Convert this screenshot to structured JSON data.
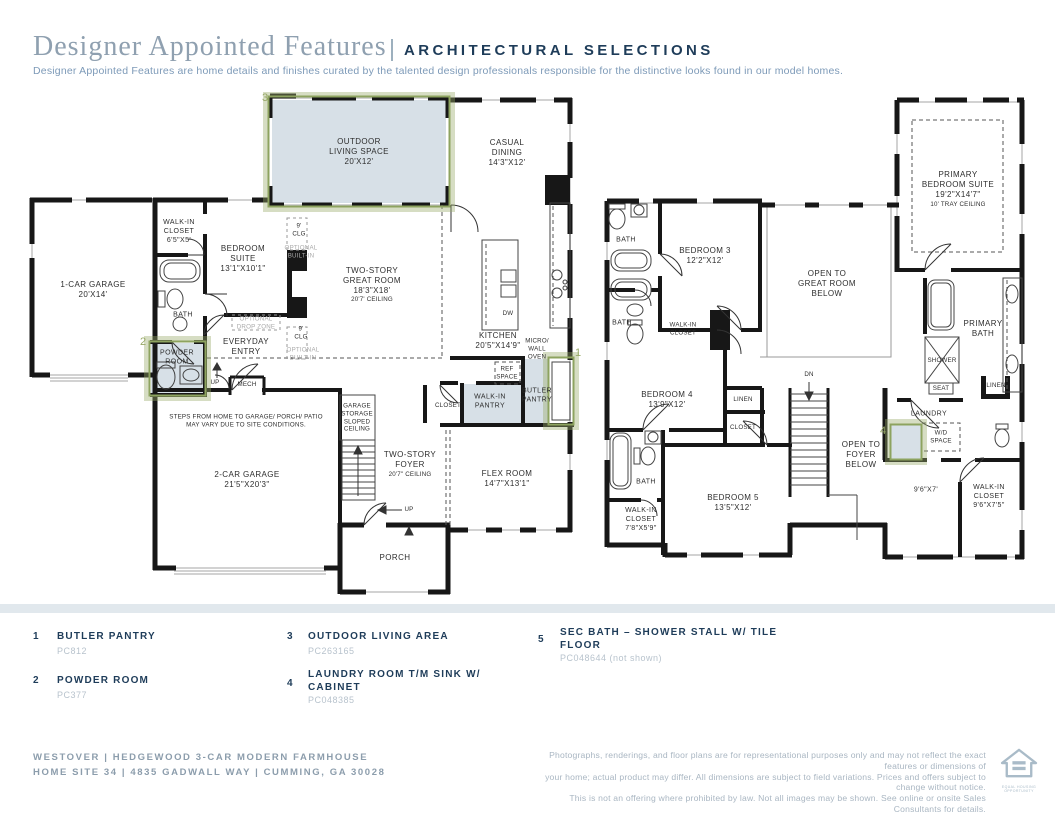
{
  "header": {
    "title": "Designer Appointed Features",
    "heading": "ARCHITECTURAL SELECTIONS",
    "description": "Designer Appointed Features are home details and finishes curated by the talented design professionals responsible for the distinctive looks found in our model homes."
  },
  "plan1": {
    "markers": {
      "m1": "1",
      "m2": "2",
      "m3": "3"
    },
    "labels": {
      "outdoor": "OUTDOOR\nLIVING SPACE\n20'X12'",
      "casual": "CASUAL\nDINING\n14'3\"X12'",
      "wic": "WALK-IN\nCLOSET\n6'5\"X5'",
      "suite": "BEDROOM\nSUITE\n13'1\"X10'1\"",
      "garage1": "1-CAR GARAGE\n20'X14'",
      "bath": "BATH",
      "clg_a": "9'\nCLG",
      "opt_a": "OPTIONAL\nBUILT-IN",
      "clg_b": "9'\nCLG",
      "opt_b": "OPTIONAL\nBUILT-IN",
      "great": "TWO-STORY\nGREAT ROOM\n18'3\"X18'",
      "great_clg": "20'7' CEILING",
      "dropzone": "OPTIONAL\nDROP ZONE",
      "powder": "POWDER\nROOM",
      "everyday": "EVERYDAY\nENTRY",
      "up_a": "UP",
      "mech": "MECH",
      "kitchen": "KITCHEN\n20'5\"X14'9\"",
      "micro": "MICRO/\nWALL\nOVEN",
      "ref": "REF\nSPACE",
      "dw": "DW",
      "butler": "BUTLER\nPANTRY",
      "pantry": "WALK-IN\nPANTRY",
      "closet": "CLOSET",
      "flex": "FLEX ROOM\n14'7\"X13'1\"",
      "steps": "STEPS FROM HOME TO GARAGE/ PORCH/ PATIO\nMAY VARY DUE TO SITE CONDITIONS.",
      "garage2": "2-CAR GARAGE\n21'5\"X20'3\"",
      "storage": "GARAGE\nSTORAGE\nSLOPED\nCEILING",
      "foyer": "TWO-STORY\nFOYER",
      "foyer_clg": "20'7\" CEILING",
      "up_b": "UP",
      "porch": "PORCH"
    }
  },
  "plan2": {
    "markers": {
      "m4": "4"
    },
    "labels": {
      "bath_a": "BATH",
      "bedroom3": "BEDROOM 3\n12'2\"X12'",
      "bath_b": "BATH",
      "wic_a": "WALK-IN\nCLOSET",
      "open_great": "OPEN TO\nGREAT ROOM\nBELOW",
      "primary": "PRIMARY\nBEDROOM SUITE\n19'2\"X14'7\"",
      "primary_clg": "10' TRAY CEILING",
      "bedroom4": "BEDROOM 4\n13'9\"X12'",
      "linen_a": "LINEN",
      "closet": "CLOSET",
      "dn": "DN",
      "open_foyer": "OPEN TO\nFOYER\nBELOW",
      "laundry": "LAUNDRY",
      "wd": "W/D\nSPACE",
      "shower": "SHOWER",
      "seat": "SEAT",
      "primary_bath": "PRIMARY\nBATH",
      "linen_b": "LINEN",
      "room97": "9'6\"X7'",
      "wic_b": "WALK-IN\nCLOSET\n9'6\"X7'5\"",
      "bath_c": "BATH",
      "wic_c": "WALK-IN\nCLOSET\n7'8\"X5'9\"",
      "bedroom5": "BEDROOM 5\n13'5\"X12'"
    }
  },
  "legend": {
    "items": [
      {
        "num": "1",
        "title": "BUTLER PANTRY",
        "code": "PC812"
      },
      {
        "num": "2",
        "title": "POWDER ROOM",
        "code": "PC377"
      },
      {
        "num": "3",
        "title": "OUTDOOR LIVING AREA",
        "code": "PC263165"
      },
      {
        "num": "4",
        "title": "LAUNDRY ROOM T/M SINK W/\nCABINET",
        "code": "PC048385"
      },
      {
        "num": "5",
        "title": "SEC BATH – SHOWER STALL W/ TILE\nFLOOR",
        "code": "PC048644 (not shown)"
      }
    ]
  },
  "footer": {
    "address": "WESTOVER | HEDGEWOOD 3-CAR MODERN FARMHOUSE\nHOME SITE 34 | 4835 GADWALL WAY | CUMMING, GA 30028",
    "disclaimer": "Photographs, renderings, and floor plans are for representational purposes only and may not reflect the exact features or dimensions of\nyour home; actual product may differ. All dimensions are subject to field variations. Prices and offers subject to change without notice.\nThis is not an offering where prohibited by law. Not all images may be shown. See online or onsite Sales Consultants for details.",
    "logo_caption": "EQUAL HOUSING\nOPPORTUNITY"
  },
  "colors": {
    "navy": "#1e3c59",
    "title_gray": "#8fa0b0",
    "subtitle_blue": "#7d9ab8",
    "highlight_green": "#98a968",
    "room_shade": "#d7e0e7",
    "wall_black": "#171717",
    "band_gray": "#e1e8ed"
  }
}
